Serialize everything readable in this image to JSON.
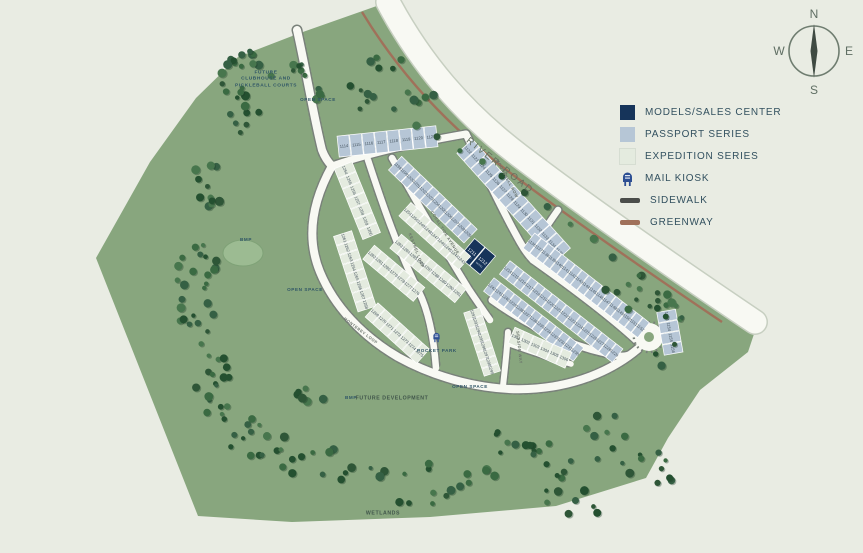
{
  "colors": {
    "background": "#e9ece3",
    "land": "#88a67e",
    "road": "#f8f9f3",
    "road_edge": "#c7cfc1",
    "sidewalk_dash": "#79817a",
    "greenway": "#a0715a",
    "pond": "#9cbb92",
    "pond_edge": "#7fa277"
  },
  "compass": {
    "n": "N",
    "e": "E",
    "s": "S",
    "w": "W"
  },
  "legend": {
    "items": [
      {
        "key": "models_sales_center",
        "label": "MODELS/SALES CENTER",
        "swatch": "#16345a",
        "kind": "square"
      },
      {
        "key": "passport_series",
        "label": "PASSPORT SERIES",
        "swatch": "#b6c6d6",
        "kind": "square"
      },
      {
        "key": "expedition_series",
        "label": "EXPEDITION SERIES",
        "swatch": "#e4ebdf",
        "kind": "square"
      },
      {
        "key": "mail_kiosk",
        "label": "MAIL KIOSK",
        "swatch": "#2d4f93",
        "kind": "kiosk"
      },
      {
        "key": "sidewalk",
        "label": "SIDEWALK",
        "swatch": "#4a4d4a",
        "kind": "line"
      },
      {
        "key": "greenway",
        "label": "GREENWAY",
        "swatch": "#a0715a",
        "kind": "line"
      }
    ]
  },
  "labels": {
    "river_road": "RIVER ROAD",
    "future_clubhouse": "FUTURE\nCLUBHOUSE AND\nPICKLEBALL COURTS",
    "open_space": "OPEN SPACE",
    "pocket_park": "POCKET PARK",
    "future_development": "FUTURE DEVELOPMENT",
    "wetlands": "WETLANDS",
    "bmp": "BMP"
  },
  "streets": {
    "monterey_loop": "MONTEREY LOOP",
    "kestrel_loop": "KESTREL LOOP",
    "coral_tide": "CORAL TIDE AVENUE",
    "moonshell_row": "MOONSHELL ROW",
    "seaside_way": "SEASIDE WAY"
  },
  "map": {
    "series_colors": {
      "passport": "#b6c6d6",
      "expedition": "#e4ebdf",
      "models": "#16345a"
    },
    "lot_text_color": "#46555f",
    "models_caption": "MODEL",
    "blocks": [
      {
        "name": "1114-1121",
        "series": "passport",
        "lots": [
          1114,
          1115,
          1116,
          1117,
          1118,
          1119,
          1120,
          1121
        ],
        "x": 344,
        "y": 146,
        "angle": -6,
        "step": 12.5,
        "depth": 21
      },
      {
        "name": "1122-1135",
        "series": "passport",
        "lots": [
          1122,
          1123,
          1124,
          1125,
          1126,
          1127,
          1128,
          1129,
          1130,
          1131,
          1132,
          1133,
          1134,
          1135
        ],
        "x": 468,
        "y": 150,
        "angle": 48,
        "step": 10.5,
        "depth": 21
      },
      {
        "name": "1136-1152",
        "series": "passport",
        "lots": [
          1136,
          1137,
          1138,
          1139,
          1140,
          1141,
          1142,
          1143,
          1144,
          1145,
          1146,
          1147,
          1148,
          1149,
          1150,
          1151,
          1152
        ],
        "x": 532,
        "y": 243,
        "angle": 38,
        "step": 8.6,
        "depth": 19
      },
      {
        "name": "1153-1156",
        "series": "passport",
        "lots": [
          1153,
          1154,
          1155,
          1156
        ],
        "x": 667,
        "y": 316,
        "angle": 80,
        "step": 11,
        "depth": 19
      },
      {
        "name": "1198-1209",
        "series": "passport",
        "lots": [
          1198,
          1199,
          1200,
          1201,
          1202,
          1203,
          1204,
          1205,
          1206,
          1207,
          1208,
          1209
        ],
        "x": 398,
        "y": 166,
        "angle": 44,
        "step": 8.8,
        "depth": 19
      },
      {
        "name": "models-1211-1212",
        "series": "models",
        "lots": [
          1211,
          1212
        ],
        "x": 472,
        "y": 252,
        "angle": 40,
        "step": 14,
        "depth": 24
      },
      {
        "name": "1214-1229",
        "series": "passport",
        "lots": [
          1214,
          1215,
          1216,
          1217,
          1218,
          1219,
          1220,
          1221,
          1222,
          1223,
          1224,
          1225,
          1226,
          1227,
          1228,
          1229
        ],
        "x": 508,
        "y": 270,
        "angle": 38,
        "step": 9,
        "depth": 17
      },
      {
        "name": "1230-1242",
        "series": "passport",
        "lots": [
          1242,
          1241,
          1240,
          1239,
          1238,
          1237,
          1236,
          1235,
          1234,
          1233,
          1232,
          1231,
          1230
        ],
        "x": 492,
        "y": 287,
        "angle": 38,
        "step": 8.8,
        "depth": 17
      },
      {
        "name": "1243-1251",
        "series": "expedition",
        "lots": [
          1251,
          1250,
          1249,
          1248,
          1247,
          1246,
          1245,
          1244,
          1243
        ],
        "x": 408,
        "y": 212,
        "angle": 42,
        "step": 9,
        "depth": 18
      },
      {
        "name": "1254-1260",
        "series": "expedition",
        "lots": [
          1254,
          1255,
          1256,
          1257,
          1258,
          1259,
          1260
        ],
        "x": 345,
        "y": 170,
        "angle": 68,
        "step": 11,
        "depth": 19
      },
      {
        "name": "1261-1268",
        "series": "expedition",
        "lots": [
          1261,
          1262,
          1263,
          1264,
          1265,
          1266,
          1267,
          1268
        ],
        "x": 344,
        "y": 238,
        "angle": 72,
        "step": 10,
        "depth": 19
      },
      {
        "name": "1269-1275",
        "series": "expedition",
        "lots": [
          1269,
          1270,
          1271,
          1272,
          1273,
          1274,
          1275
        ],
        "x": 375,
        "y": 313,
        "angle": 42,
        "step": 10,
        "depth": 19
      },
      {
        "name": "1276-1282",
        "series": "expedition",
        "lots": [
          1282,
          1281,
          1280,
          1279,
          1278,
          1277,
          1276
        ],
        "x": 372,
        "y": 255,
        "angle": 40,
        "step": 9.5,
        "depth": 18
      },
      {
        "name": "1283-1291",
        "series": "expedition",
        "lots": [
          1283,
          1284,
          1285,
          1286,
          1287,
          1288,
          1289,
          1290,
          1291
        ],
        "x": 399,
        "y": 244,
        "angle": 40,
        "step": 9.5,
        "depth": 18
      },
      {
        "name": "1292-1299",
        "series": "expedition",
        "lots": [
          1292,
          1293,
          1294,
          1295,
          1296,
          1297,
          1298,
          1299
        ],
        "x": 473,
        "y": 314,
        "angle": 72,
        "step": 8.4,
        "depth": 17
      },
      {
        "name": "1301-1306",
        "series": "expedition",
        "lots": [
          1301,
          1302,
          1303,
          1304,
          1305,
          1306
        ],
        "x": 516,
        "y": 337,
        "angle": 24,
        "step": 10.5,
        "depth": 17
      }
    ]
  }
}
